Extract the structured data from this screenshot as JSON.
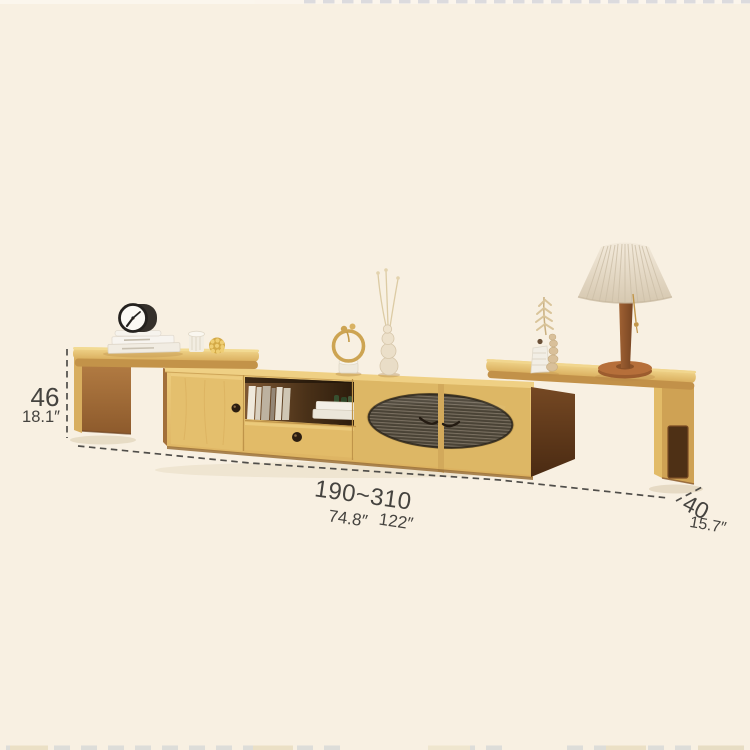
{
  "image": {
    "type": "product-dimension-photo",
    "background_color": "#F8F0E2",
    "annotation_text_color": "#45433F"
  },
  "colors": {
    "wood_light": "#E9C878",
    "wood_top": "#DFB665",
    "wood_edge": "#C29149",
    "wood_dark_side": "#5E3A1D",
    "glass_dark": "#4A4336",
    "lamp_shade": "#EDE3D2",
    "watermark_gray": "#D8D8DE"
  },
  "scene_objects": [
    "extendable-tv-stand",
    "left-extension-table",
    "right-extension-table",
    "cabinet-door",
    "open-shelf-with-books",
    "drawer",
    "fluted-glass-doors",
    "alarm-clock",
    "book-stack",
    "ribbed-cup",
    "woven-ball-ornament",
    "ring-sculpture",
    "gourd-vase-with-dried-stems",
    "stepped-vase-with-wheat",
    "pleated-table-lamp"
  ],
  "dimensions": {
    "height": {
      "cm": "46",
      "inch": "18.1″"
    },
    "length": {
      "cm": "190~310",
      "inch_min": "74.8″",
      "inch_max": "122″"
    },
    "depth": {
      "cm": "40",
      "inch": "15.7″"
    }
  }
}
